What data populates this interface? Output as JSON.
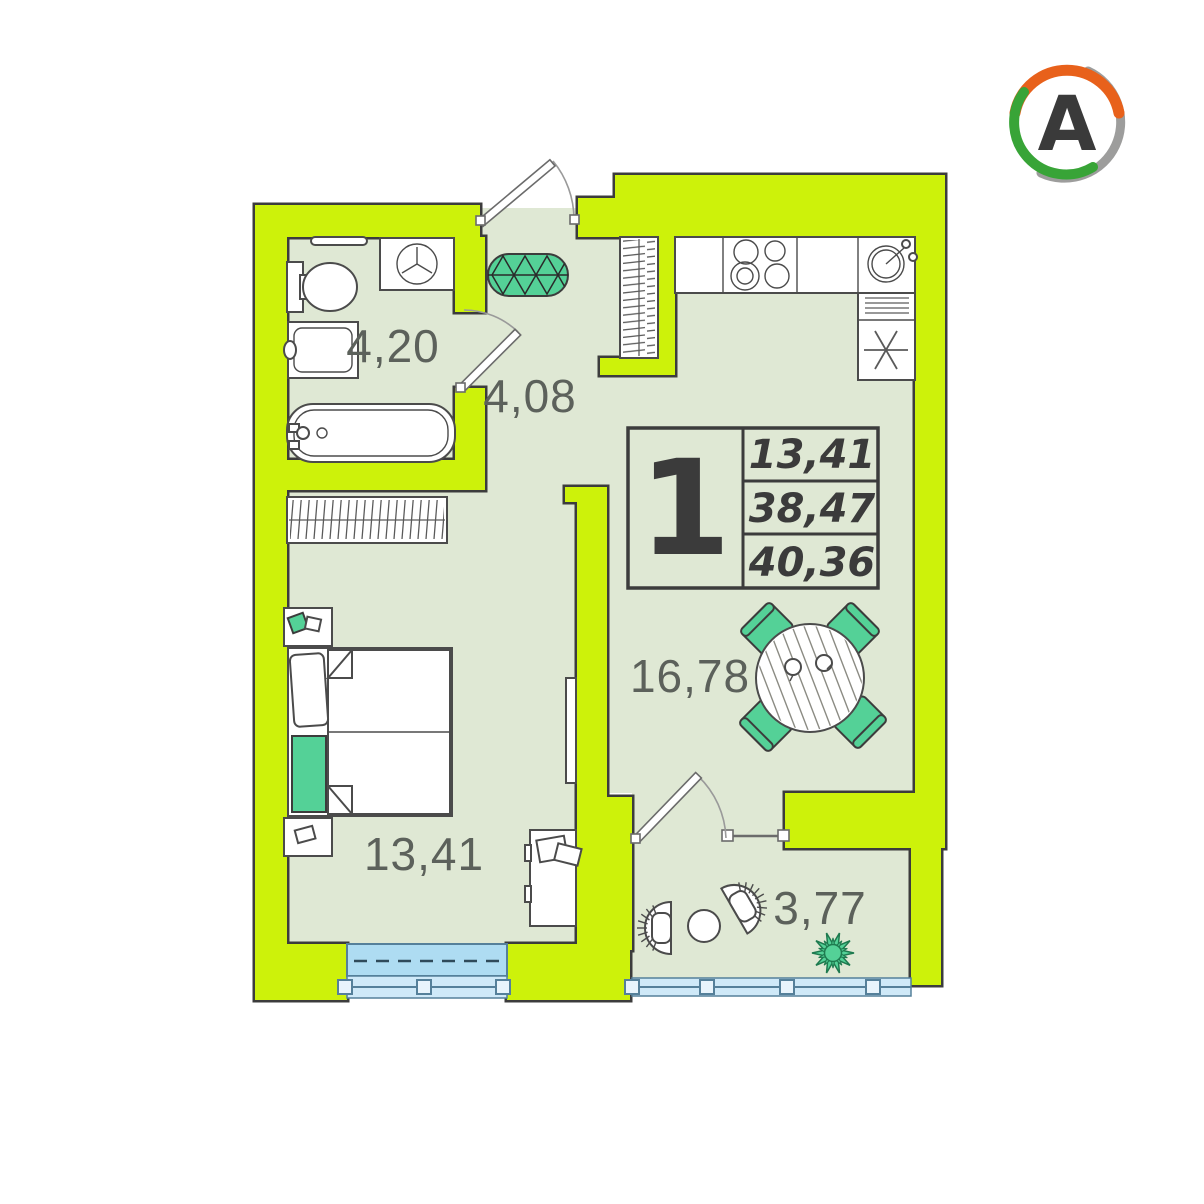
{
  "logo": {
    "letter": "A",
    "ring_colors": {
      "orange": "#e8611b",
      "green": "#38a437",
      "gray": "#9d9d9c"
    }
  },
  "palette": {
    "wall": "#cdf20a",
    "floor": "#dfe8d4",
    "outline": "#3c3c3c",
    "furniture_green": "#54d197",
    "glass_blue": "#aedcf2",
    "glass_light": "#cfe9f8",
    "label_gray": "#5c615b",
    "info_text": "#3b3b3b"
  },
  "rooms": [
    {
      "id": "bathroom",
      "area": "4,20"
    },
    {
      "id": "hallway",
      "area": "4,08"
    },
    {
      "id": "bedroom",
      "area": "13,41"
    },
    {
      "id": "kitchen-living",
      "area": "16,78"
    },
    {
      "id": "balcony",
      "area": "3,77"
    }
  ],
  "info_box": {
    "rooms_count": "1",
    "living_area": "13,41",
    "area_without_balcony": "38,47",
    "total_area": "40,36"
  }
}
